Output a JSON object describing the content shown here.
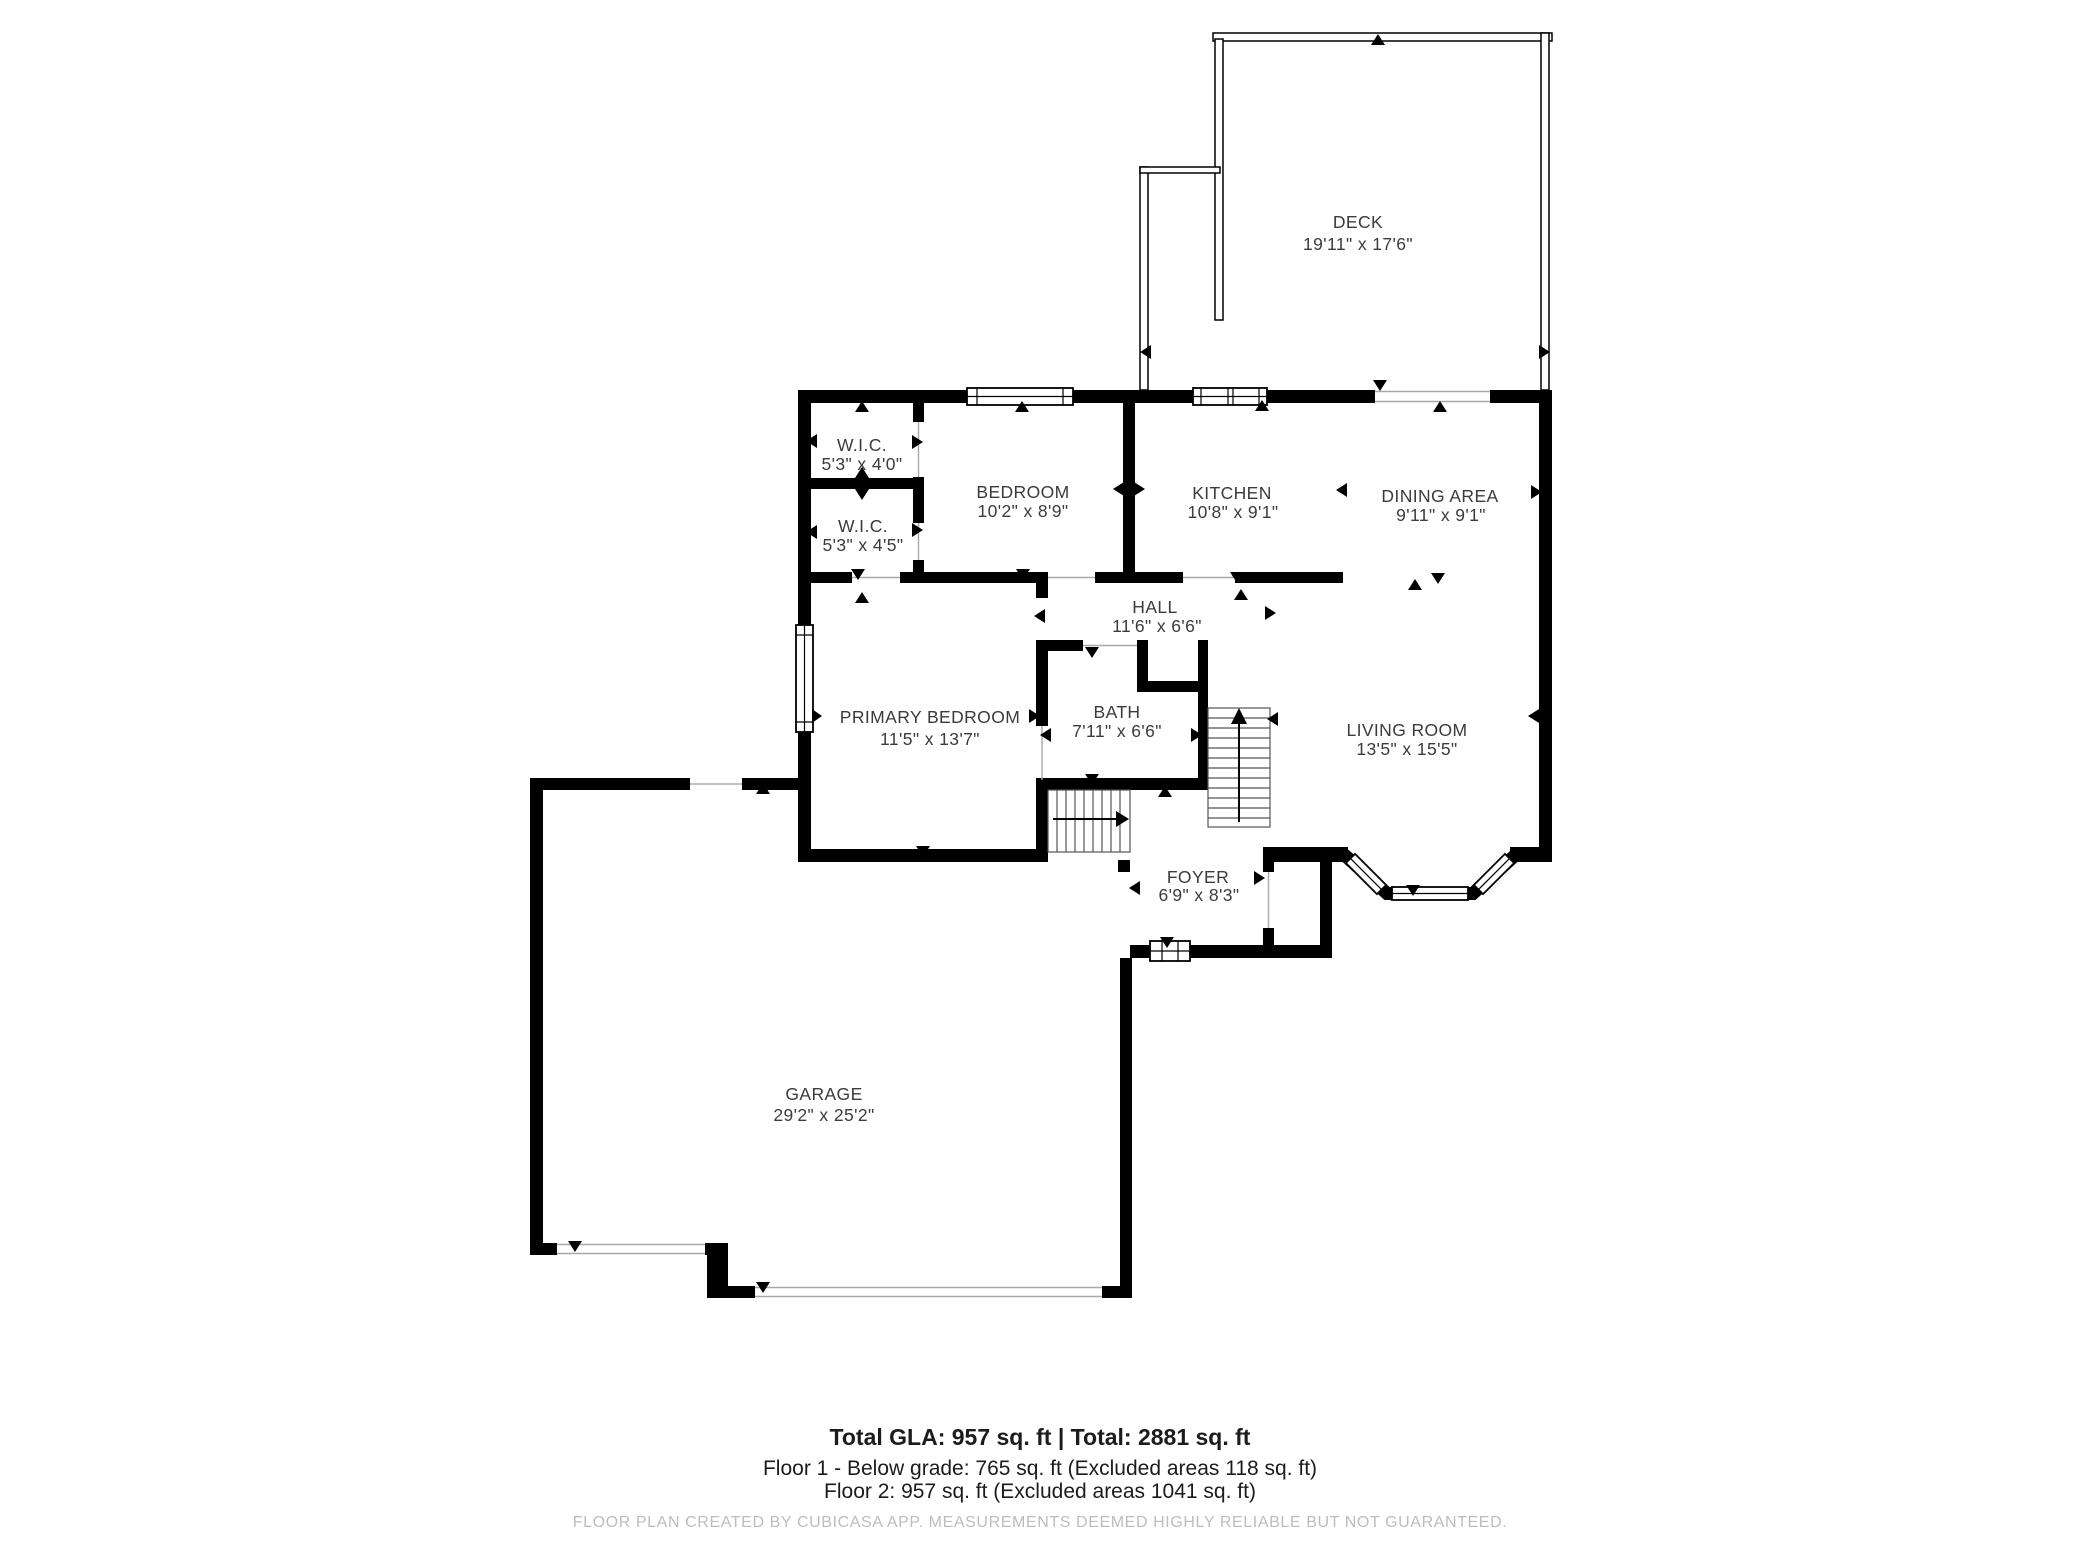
{
  "floor_plan": {
    "rooms": [
      {
        "id": "deck",
        "name": "DECK",
        "dims": "19'11\" x 17'6\""
      },
      {
        "id": "wic-1",
        "name": "W.I.C.",
        "dims": "5'3\" x 4'0\""
      },
      {
        "id": "wic-2",
        "name": "W.I.C.",
        "dims": "5'3\" x 4'5\""
      },
      {
        "id": "bedroom",
        "name": "BEDROOM",
        "dims": "10'2\" x 8'9\""
      },
      {
        "id": "kitchen",
        "name": "KITCHEN",
        "dims": "10'8\" x 9'1\""
      },
      {
        "id": "dining-area",
        "name": "DINING AREA",
        "dims": "9'11\" x 9'1\""
      },
      {
        "id": "hall",
        "name": "HALL",
        "dims": "11'6\" x 6'6\""
      },
      {
        "id": "primary-bedroom",
        "name": "PRIMARY BEDROOM",
        "dims": "11'5\" x 13'7\""
      },
      {
        "id": "bath",
        "name": "BATH",
        "dims": "7'11\" x 6'6\""
      },
      {
        "id": "living-room",
        "name": "LIVING ROOM",
        "dims": "13'5\" x 15'5\""
      },
      {
        "id": "foyer",
        "name": "FOYER",
        "dims": "6'9\" x 8'3\""
      },
      {
        "id": "garage",
        "name": "GARAGE",
        "dims": "29'2\" x 25'2\""
      }
    ],
    "footer": {
      "line1": "Total GLA: 957 sq. ft | Total: 2881 sq. ft",
      "line2": "Floor 1 - Below grade: 765 sq. ft (Excluded areas 118 sq. ft)",
      "line3": "Floor 2: 957 sq. ft (Excluded areas 1041 sq. ft)",
      "disclaimer": "FLOOR PLAN CREATED BY CUBICASA APP. MEASUREMENTS DEEMED HIGHLY RELIABLE BUT NOT GUARANTEED."
    },
    "colors": {
      "wall": "#000000",
      "background": "#ffffff",
      "label_text": "#3b3b3b",
      "disclaimer_text": "#bdbdbd"
    }
  }
}
